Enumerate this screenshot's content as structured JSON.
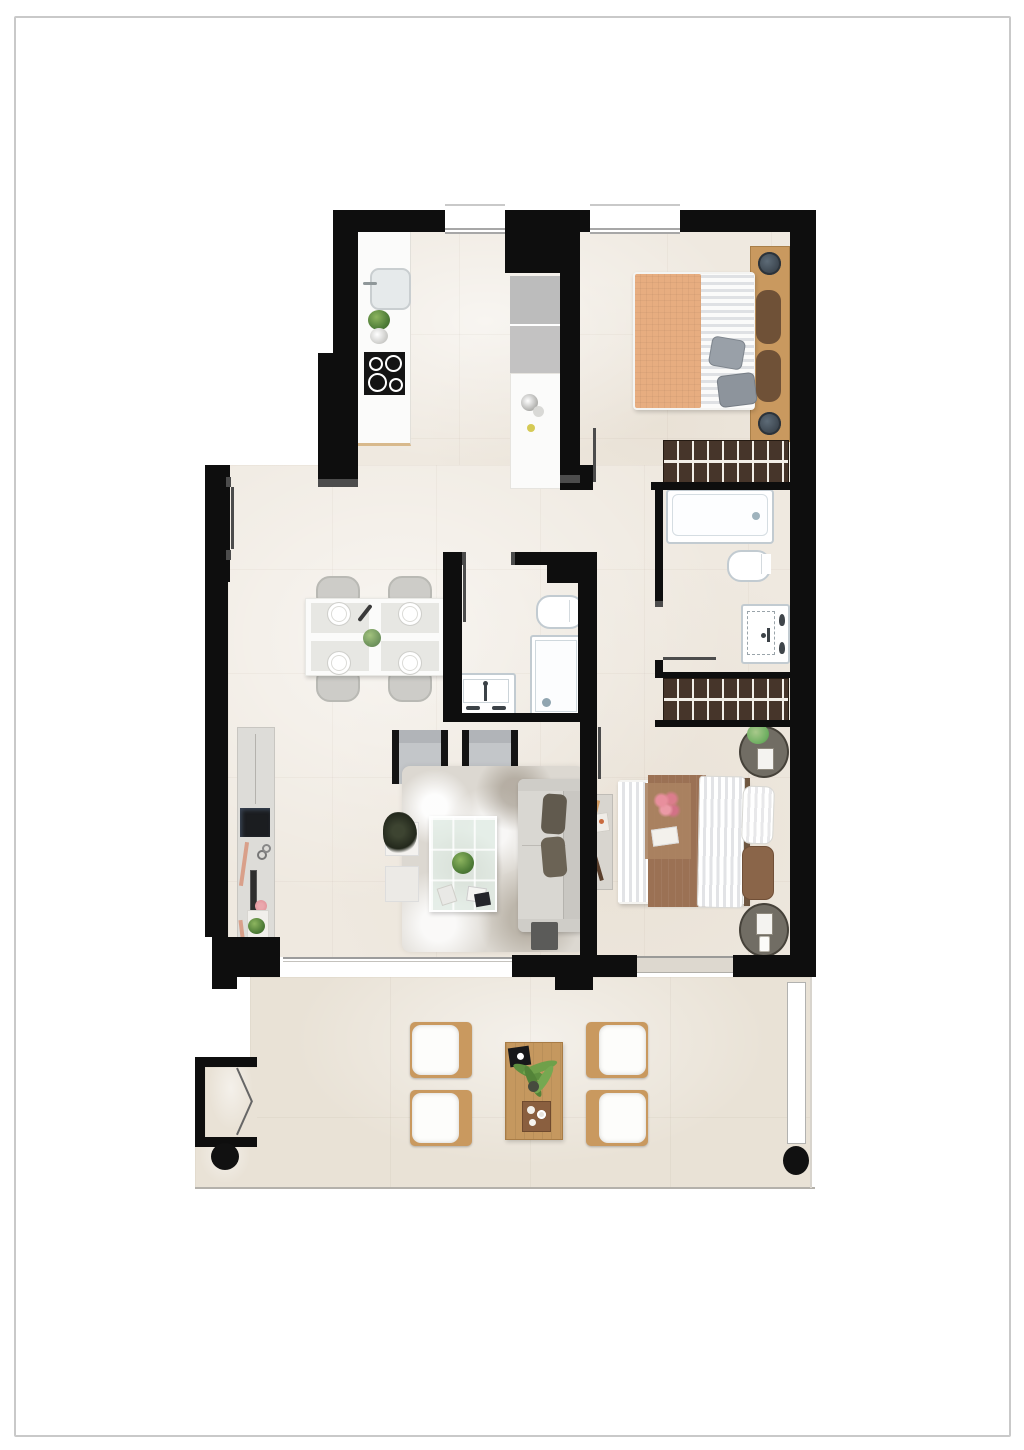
{
  "document": {
    "type": "residential-apartment-floor-plan",
    "view": "top-down-2d-render",
    "visible_text": [],
    "page_style": "white page with thin gray rectangular frame"
  },
  "palette": {
    "page_bg": "#ffffff",
    "page_frame": "#c9c9c9",
    "wall": "#0e0e0e",
    "jamb": "#4c4c4c",
    "floor": "#efe9e0",
    "terrace_floor": "#e9e2d6",
    "fixture_border": "#c2cbd1",
    "wood": "#c9995f",
    "wardrobe": "#46352a",
    "wardrobe_stripe": "#f3efe8",
    "appliance": "#bcbcbc",
    "counter": "#fbfbfa",
    "hob": "#141414",
    "bed1_blanket": "#e7ad80",
    "bed2_blanket": "#9b7154",
    "pillow_gray": "#99a0a8",
    "cushion_brown": "#6f5137",
    "sofa": "#d9d7d2",
    "sofa_cushion": "#615a4e",
    "armchair": "#c3c6c9",
    "rug": "#dcd8d1",
    "chair_gray": "#cdccc8",
    "plant": "#4f7d38",
    "balustrade": "#9c9c9c",
    "column": "#111111",
    "tv": "#1b1d20",
    "accent_flower": "#e2899a"
  },
  "rooms": [
    {
      "id": "kitchen",
      "features": [
        "sink",
        "plant-pot",
        "hob-4-burners",
        "counter",
        "tall-appliance-column",
        "island-counter"
      ]
    },
    {
      "id": "bedroom-1",
      "features": [
        "double-bed-orange-blanket",
        "wood-headboard",
        "2-nightstand-lamps",
        "wardrobe",
        "window"
      ]
    },
    {
      "id": "ensuite-bathroom",
      "features": [
        "bathtub",
        "toilet",
        "washbasin-vanity"
      ]
    },
    {
      "id": "central-bathroom",
      "features": [
        "toilet",
        "shower",
        "washbasin-vanity"
      ]
    },
    {
      "id": "living-dining",
      "features": [
        "dining-table-4-chairs",
        "tv-sideboard",
        "2-armchairs",
        "rug",
        "glass-coffee-table",
        "sofa",
        "ottoman",
        "side-tables"
      ]
    },
    {
      "id": "bedroom-2",
      "features": [
        "double-bed-brown-blanket",
        "2-round-nightstands",
        "wardrobe",
        "console",
        "window"
      ]
    },
    {
      "id": "hallway",
      "features": [
        "doors-to-bedrooms-and-bathroom"
      ]
    },
    {
      "id": "terrace",
      "features": [
        "4-lounge-chairs",
        "wood-coffee-table",
        "plant",
        "tray",
        "2-round-columns",
        "storage-niche-bifold-door",
        "glass-balustrade",
        "planter"
      ]
    }
  ],
  "counts": {
    "windows_top": 2,
    "terrace_chairs": 4,
    "dining_plates": 4,
    "bedrooms": 2,
    "bathrooms": 2
  }
}
